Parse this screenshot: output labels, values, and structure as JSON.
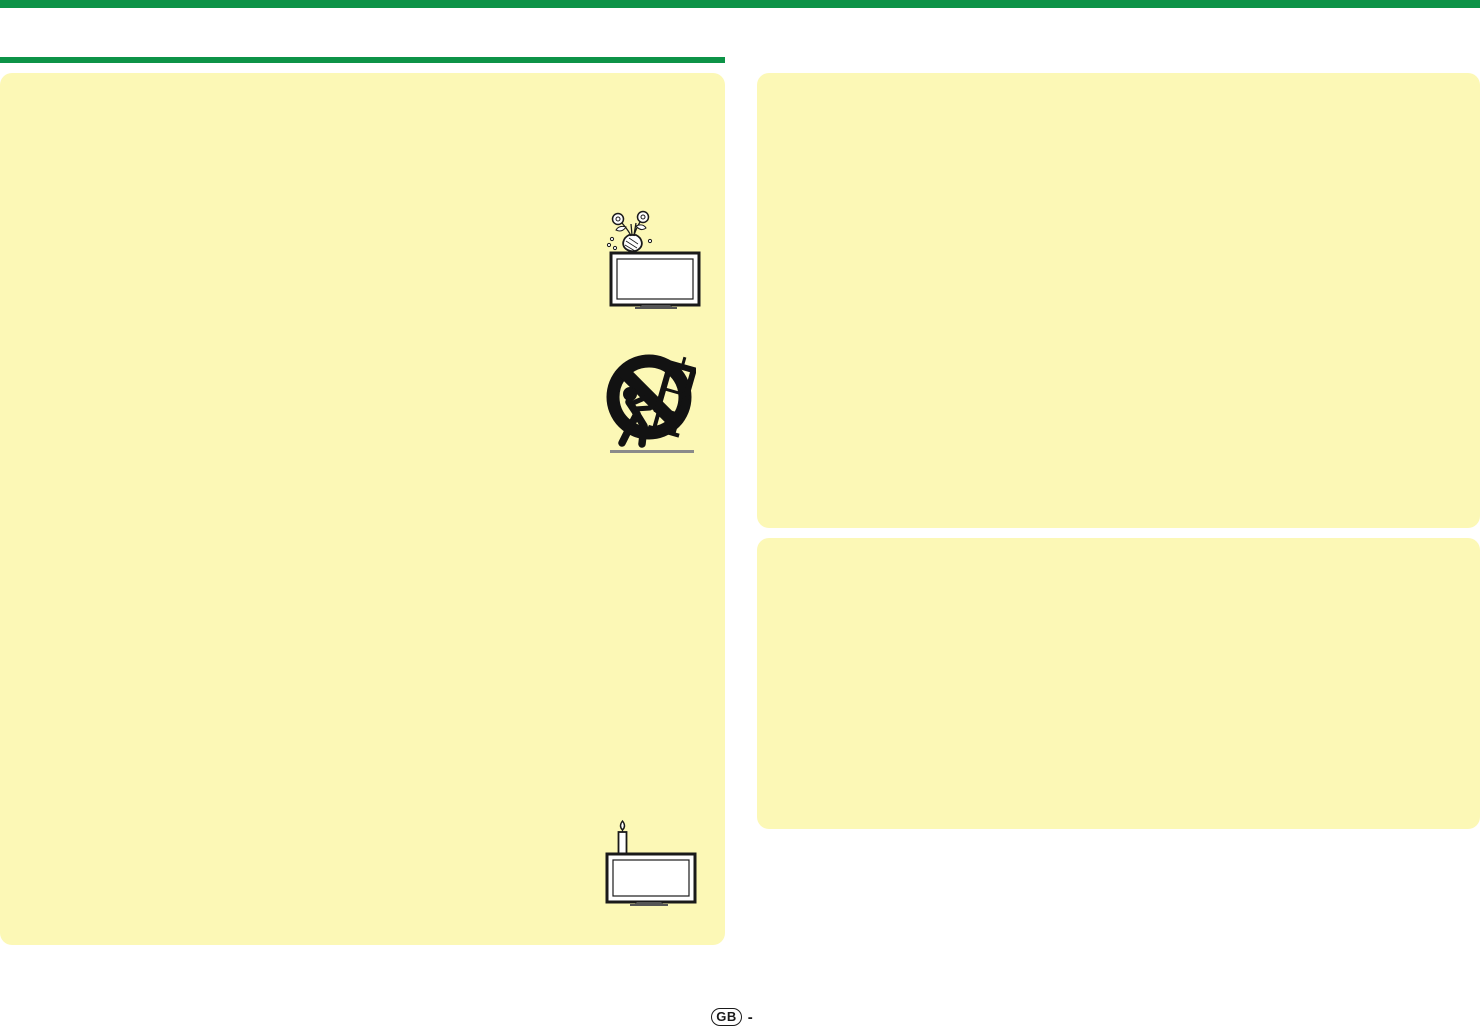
{
  "colors": {
    "accent_green": "#0D9347",
    "panel_yellow": "#FCF8B6",
    "ink": "#1A1A1A",
    "ground_gray": "#8A8A8A",
    "background": "#FFFFFF"
  },
  "header": {
    "top_bar": "full-width green bar",
    "section_rule": "green rule above left column"
  },
  "panels": [
    {
      "id": "left-safety-panel",
      "text": ""
    },
    {
      "id": "right-top-panel",
      "text": ""
    },
    {
      "id": "right-bottom-panel",
      "text": ""
    }
  ],
  "icons": [
    {
      "name": "tv-vase-water-warning-icon",
      "meaning": "vase of flowers dripping water on top of a TV"
    },
    {
      "name": "no-cart-tipover-prohibition-icon",
      "meaning": "prohibition circle: person pushing TV on tipping cart"
    },
    {
      "name": "tv-candle-flame-warning-icon",
      "meaning": "lit candle standing behind a TV"
    }
  ],
  "footer": {
    "language_badge": "GB",
    "page_separator": "-"
  }
}
